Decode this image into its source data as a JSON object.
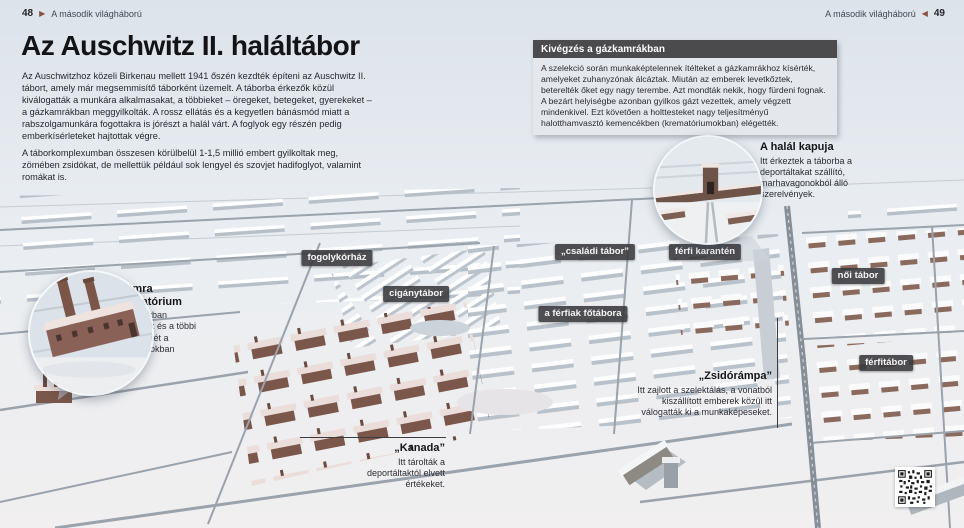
{
  "page": {
    "left_header": {
      "page_number": "48",
      "arrow": "▶",
      "section": "A második világháború"
    },
    "right_header": {
      "section": "A második világháború",
      "arrow": "◀",
      "page_number": "49"
    }
  },
  "article": {
    "title": "Az Auschwitz II. haláltábor",
    "paragraph1": "Az Auschwitzhoz közeli Birkenau mellett 1941 őszén kezdték építeni az Auschwitz II. tábort, amely már megsemmisítő táborként üzemelt. A táborba érkezők közül kiválogatták a munkára alkalmasakat, a többieket – öregeket, betegeket, gyerekeket – a gázkamrákban meggyilkolták. A rossz ellátás és a kegyetlen bánásmód miatt a rabszolgamunkára fogottakra is jórészt a halál várt. A foglyok egy részén pedig emberkísérleteket hajtottak végre.",
    "paragraph2": "A táborkomplexumban összesen körülbelül 1-1,5 millió embert gyilkoltak meg, zömében zsidókat, de mellettük például sok lengyel és szovjet hadifoglyot, valamint romákat is."
  },
  "infobox": {
    "title": "Kivégzés a gázkamrákban",
    "body": "A szelekció során munkaképtelennek ítélteket a gázkamrákhoz kísérték, amelyeket zuhanyzónak álcáztak. Miután az emberek levetkőztek, beterelték őket egy nagy terembe. Azt mondták nekik, hogy fürdeni fognak. A bezárt helyiségbe azonban gyilkos gázt vezettek, amely végzett mindenkivel. Ezt követően a holttesteket nagy teljesítményű halotthamvasztó kemencékben (krematóriumokban) elégették."
  },
  "callouts": {
    "death_gate": {
      "title": "A halál kapuja",
      "body": "Itt érkeztek a táborba a deportáltakat szállító, marhavagonokból álló szerelvények."
    },
    "gas_chamber": {
      "title_line1": "Gázkamra",
      "title_line2": "és krematórium",
      "body": "A gázkamrákban meggyilkoltak és a többi halott holttestét a krematóriumokban égették el."
    },
    "jewish_ramp": {
      "title": "„Zsidórámpa”",
      "body": "Itt zajlott a szelektálás, a vonatból kiszállított emberek közül itt válogatták ki a munkaképeseket."
    },
    "kanada": {
      "title": "„Kanada”",
      "body": "Itt tárolták a deportáltaktól elvett értékeket."
    }
  },
  "map_labels": [
    {
      "label": "fogolykórház"
    },
    {
      "label": "cigánytábor"
    },
    {
      "label": "„családi tábor”"
    },
    {
      "label": "férfi karantén"
    },
    {
      "label": "női tábor"
    },
    {
      "label": "a férfiak főtábora"
    },
    {
      "label": "férfitábor"
    }
  ],
  "colors": {
    "page_background": "#e2e7ed",
    "label_background": "#38383b",
    "infobox_header_background": "#4b4b4e",
    "arrow_accent": "#8a5242",
    "brick": "#7b564b"
  }
}
